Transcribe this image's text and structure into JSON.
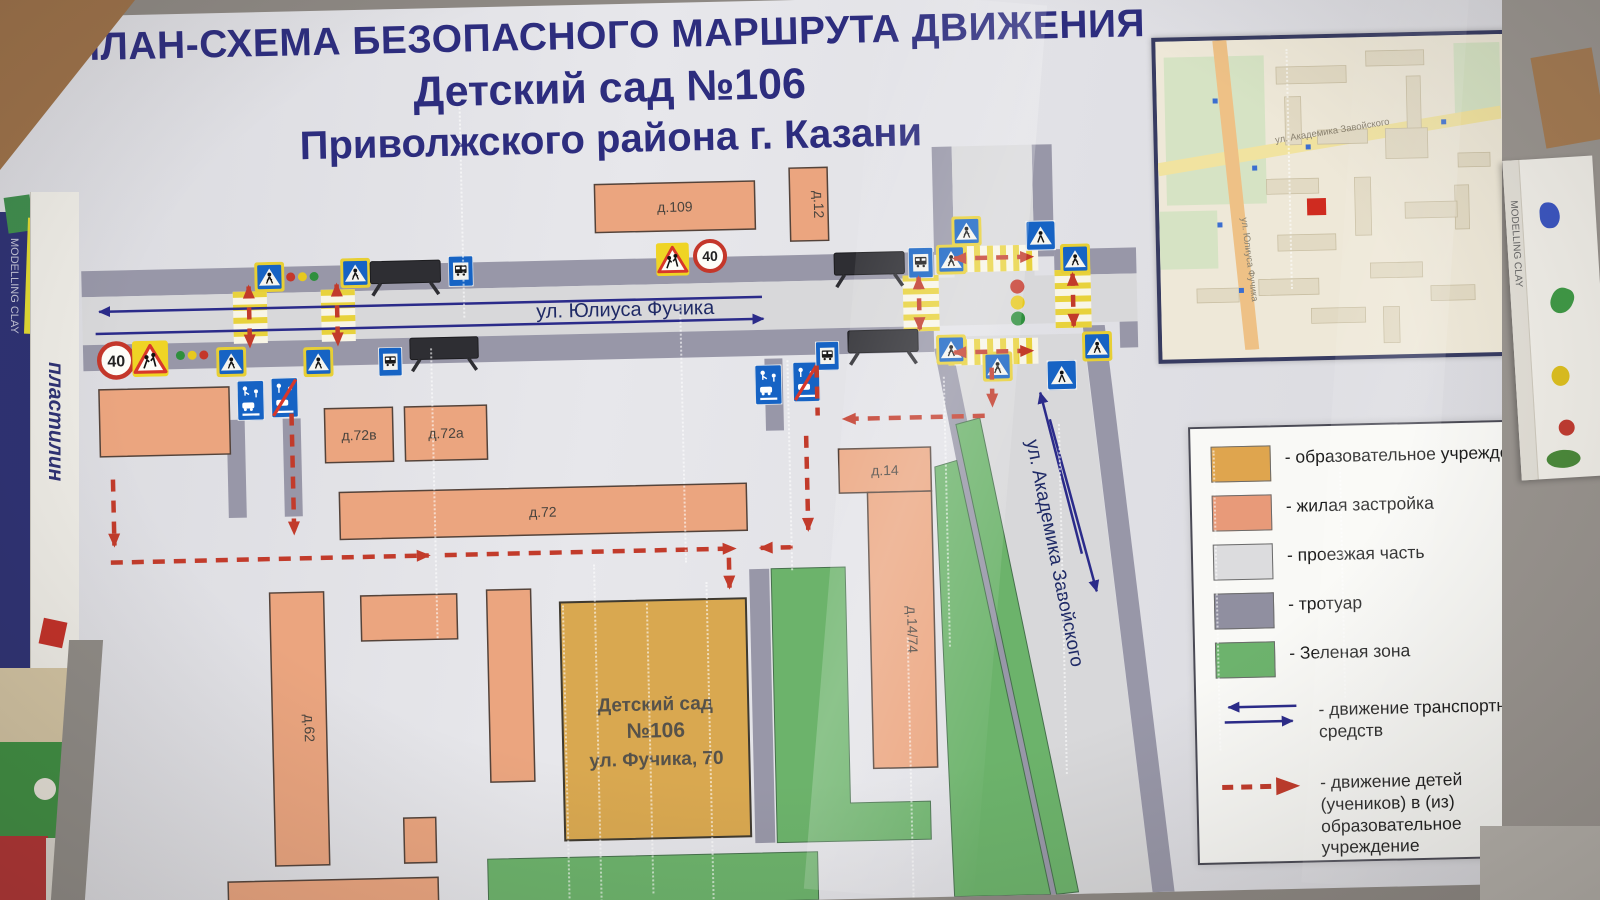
{
  "poster": {
    "title_line1": "ПЛАН-СХЕМА БЕЗОПАСНОГО МАРШРУТА ДВИЖЕНИЯ",
    "title_line2": "Детский сад №106",
    "title_line3": "Приволжского района г. Казани"
  },
  "map": {
    "street_main": "ул. Юлиуса Фучика",
    "street_cross": "ул. Академика Завойского",
    "buildings": [
      {
        "label": "д.109"
      },
      {
        "label": "д.12"
      },
      {
        "label": "д.72в"
      },
      {
        "label": "д.72а"
      },
      {
        "label": "д.72"
      },
      {
        "label": "д.14"
      },
      {
        "label": "д.14/74"
      },
      {
        "label": "д.62"
      }
    ],
    "kindergarten": {
      "line1": "Детский сад",
      "line2": "№106",
      "line3": "ул. Фучика, 70"
    },
    "signs": {
      "speed_limit": "40"
    }
  },
  "legend": {
    "items": [
      {
        "swatch": "#dfa54e",
        "label": "- образовательное учреждение"
      },
      {
        "swatch": "#e89a79",
        "label": "- жилая застройка"
      },
      {
        "swatch": "#dcdcde",
        "label": "- проезжая часть"
      },
      {
        "swatch": "#908fa0",
        "label": "- тротуар"
      },
      {
        "swatch": "#6db36d",
        "label": "- Зеленая зона"
      },
      {
        "symbol": "blue-arrows",
        "label": "- движение транспортных средств"
      },
      {
        "symbol": "red-dashed-arrow",
        "label": "- движение детей (учеников) в (из) образовательное учреждение"
      }
    ],
    "colors": {
      "vehicle_arrow": "#2b2b8a",
      "children_route": "#c23b2b"
    }
  },
  "inset": {
    "marker_color": "#cf2b20"
  },
  "surroundings": {
    "left_box_text": "пластилин",
    "left_book_text": "MODELLING CLAY",
    "right_box_text": "MODELLING CLAY"
  }
}
